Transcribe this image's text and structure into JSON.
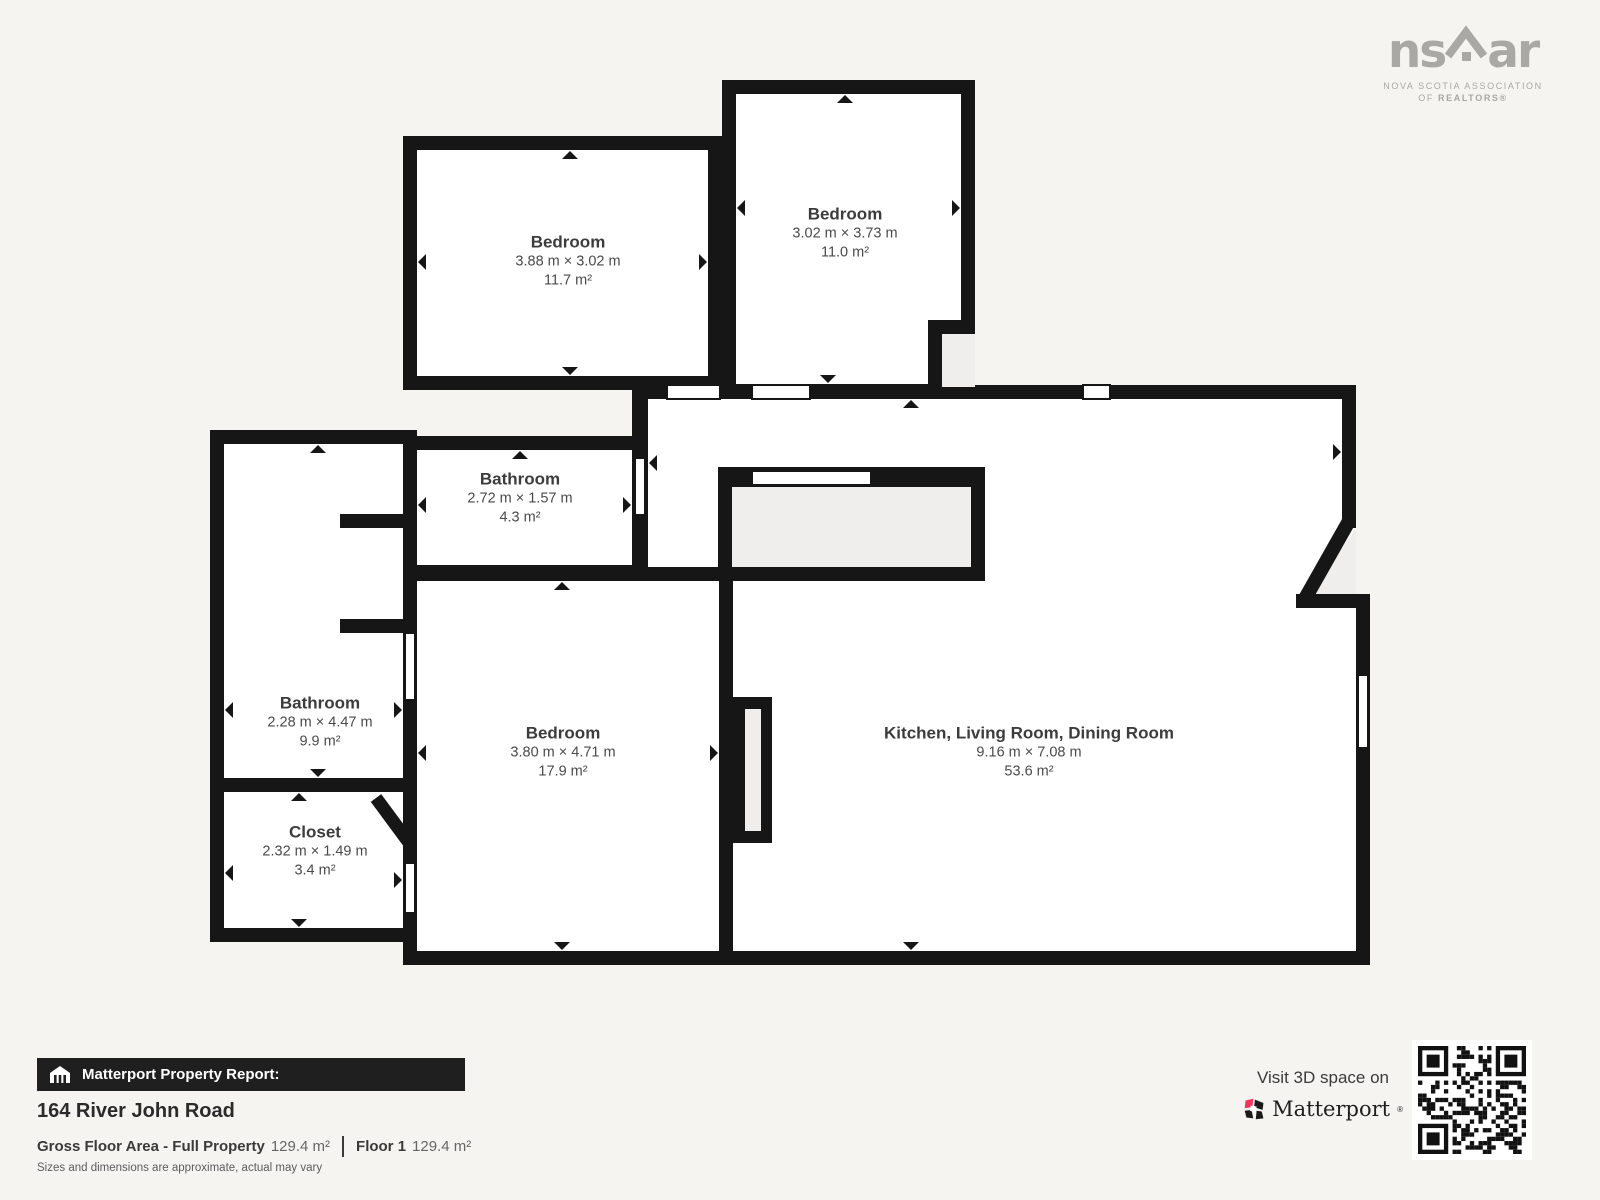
{
  "logo_nsar": {
    "text_left": "ns",
    "text_right": "ar",
    "tagline1": "NOVA SCOTIA ASSOCIATION",
    "tagline2_of": "OF ",
    "tagline2_realtors": "REALTORS®"
  },
  "rooms": [
    {
      "name": "Bedroom",
      "dims": "3.88 m × 3.02 m",
      "area": "11.7 m²"
    },
    {
      "name": "Bedroom",
      "dims": "3.02 m × 3.73 m",
      "area": "11.0 m²"
    },
    {
      "name": "Bathroom",
      "dims": "2.72 m × 1.57 m",
      "area": "4.3 m²"
    },
    {
      "name": "Bathroom",
      "dims": "2.28 m × 4.47 m",
      "area": "9.9 m²"
    },
    {
      "name": "Closet",
      "dims": "2.32 m × 1.49 m",
      "area": "3.4 m²"
    },
    {
      "name": "Bedroom",
      "dims": "3.80 m × 4.71 m",
      "area": "17.9 m²"
    },
    {
      "name": "Kitchen, Living Room, Dining Room",
      "dims": "9.16 m × 7.08 m",
      "area": "53.6 m²"
    }
  ],
  "footer": {
    "report_label": "Matterport Property Report:",
    "address": "164 River John Road",
    "gfa_label": "Gross Floor Area - Full Property",
    "gfa_value": "129.4 m²",
    "floor_label": "Floor 1",
    "floor_value": "129.4 m²",
    "disclaimer": "Sizes and dimensions are approximate, actual may vary"
  },
  "cta": {
    "visit_text": "Visit 3D space on",
    "brand": "Matterport",
    "brand_mark": "®"
  },
  "colors": {
    "wall": "#161616",
    "background": "#f5f4f1",
    "room_fill": "#ffffff",
    "unmapped_fill": "#efeeec",
    "accent_pink": "#f1355e",
    "logo_gray": "#a9a8a5"
  }
}
